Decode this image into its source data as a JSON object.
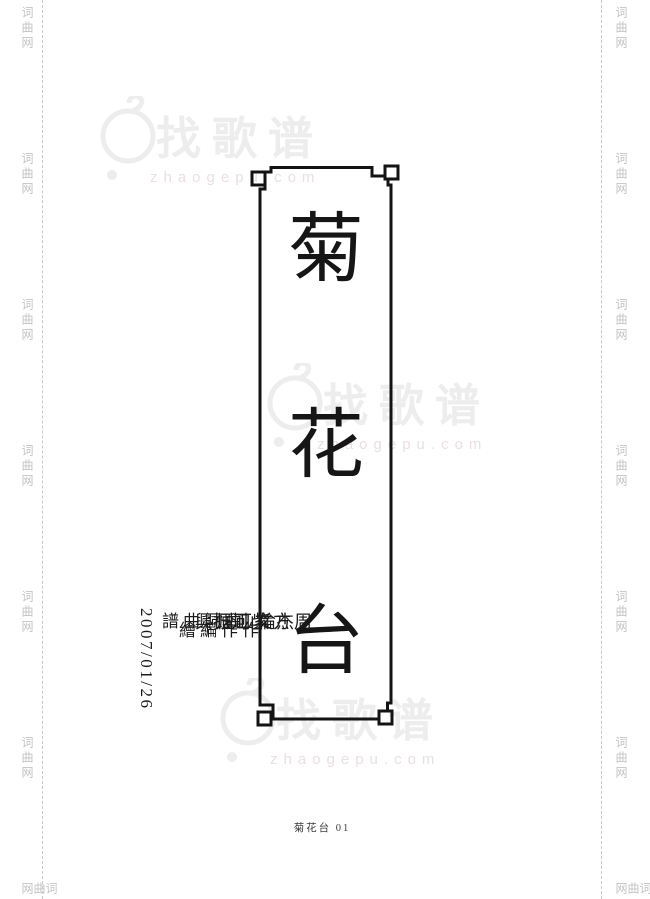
{
  "page": {
    "footer": "菊花台 01"
  },
  "rails": {
    "text": "词曲网"
  },
  "title": {
    "full": "菊花台",
    "chars": [
      "菊",
      "花",
      "台"
    ]
  },
  "credits": {
    "date": "2007/01/26",
    "columns": [
      {
        "name": "周杰倫",
        "role": "作曲"
      },
      {
        "name": "方文山",
        "role": "作詞"
      },
      {
        "name": "紫可煙",
        "role": "編曲"
      },
      {
        "name": "江振興",
        "role": "繪譜"
      }
    ]
  },
  "watermark": {
    "brand": "找歌谱",
    "domain": "zhaogepu.com"
  },
  "colors": {
    "ink": "#161616",
    "rail_gray": "#c3c3c3",
    "watermark_brand": "#ededed",
    "watermark_domain": "#e9e0e0",
    "footer_gray": "#3c3c3c"
  }
}
